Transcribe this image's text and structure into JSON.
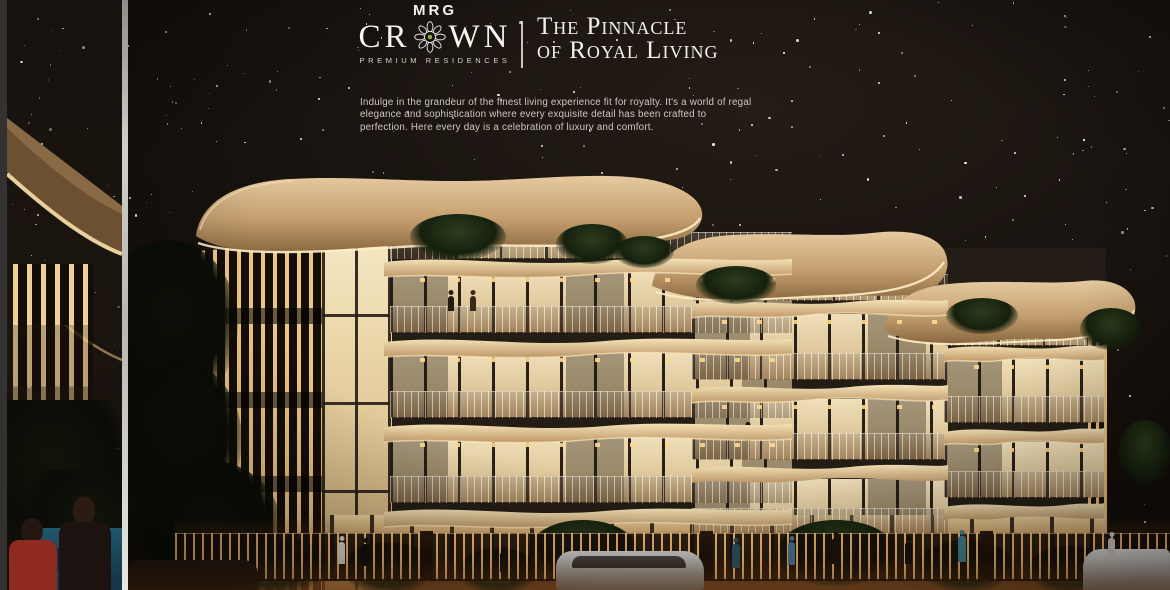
{
  "brand": {
    "name": "MRG",
    "wordmark_full": "CROWN",
    "wordmark_left": "CR",
    "wordmark_right": "WN",
    "ornament_icon": "rosette-mandala",
    "subtitle": "PREMIUM RESIDENCES"
  },
  "tagline": {
    "line1": "The Pinnacle",
    "line2": "of Royal Living"
  },
  "description": "Indulge in the grandeur of the finest living experience fit for royalty. It's a world of regal elegance and sophistication where every exquisite detail has been crafted to perfection. Here every day is a celebration of luxury and comfort.",
  "scene": {
    "type": "architectural-night-render",
    "subject": "MRG Crown premium low-rise residences, front elevation at night with starry sky, lit balconies, landscaped street with people and cars",
    "left_edge": "partial previous slide showing lit canopy, poolside and people",
    "accent_colors": {
      "canopy_tan": "#c9a474",
      "warm_glow": "#ffe9b8",
      "night_sky": "#171310",
      "divider_gray": "#c9c6c0",
      "pool_teal": "#1d5568",
      "ground_glow": "#8a4d22"
    }
  }
}
